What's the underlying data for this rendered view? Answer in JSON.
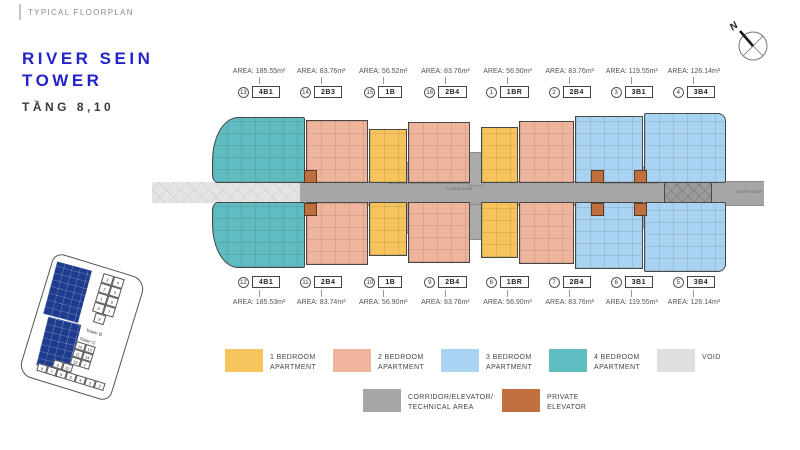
{
  "header": {
    "eyebrow": "TYPICAL FLOORPLAN"
  },
  "title": {
    "line1": "RIVER SEIN",
    "line2": "TOWER",
    "floor": "TẦNG 8,10"
  },
  "compass": {
    "north_label": "N"
  },
  "floorplan": {
    "corridor_label": "CORRIDOR",
    "corridor_label_right": "CORRIDOR",
    "top_row": [
      {
        "num": "13",
        "code": "4B1",
        "area": "AREA: 185.55m²",
        "type": "4br"
      },
      {
        "num": "14",
        "code": "2B3",
        "area": "AREA: 83.76m²",
        "type": "2br"
      },
      {
        "num": "15",
        "code": "1B",
        "area": "AREA: 56.52m²",
        "type": "1br"
      },
      {
        "num": "16",
        "code": "2B4",
        "area": "AREA: 83.76m²",
        "type": "2br"
      },
      {
        "num": "1",
        "code": "1BR",
        "area": "AREA: 56.90m²",
        "type": "1br"
      },
      {
        "num": "2",
        "code": "2B4",
        "area": "AREA: 83.76m²",
        "type": "2br"
      },
      {
        "num": "3",
        "code": "3B1",
        "area": "AREA: 119.55m²",
        "type": "3br"
      },
      {
        "num": "4",
        "code": "3B4",
        "area": "AREA: 126.14m²",
        "type": "3br"
      }
    ],
    "bottom_row": [
      {
        "num": "12",
        "code": "4B1",
        "area": "AREA: 185.53m²",
        "type": "4br"
      },
      {
        "num": "11",
        "code": "2B4",
        "area": "AREA: 83.74m²",
        "type": "2br"
      },
      {
        "num": "10",
        "code": "1B",
        "area": "AREA: 56.90m²",
        "type": "1br"
      },
      {
        "num": "9",
        "code": "2B4",
        "area": "AREA: 83.76m²",
        "type": "2br"
      },
      {
        "num": "8",
        "code": "1BR",
        "area": "AREA: 56.90m²",
        "type": "1br"
      },
      {
        "num": "7",
        "code": "2B4",
        "area": "AREA: 83.76m²",
        "type": "2br"
      },
      {
        "num": "6",
        "code": "3B1",
        "area": "AREA: 119.55m²",
        "type": "3br"
      },
      {
        "num": "5",
        "code": "3B4",
        "area": "AREA: 126.14m²",
        "type": "3br"
      }
    ]
  },
  "legend": {
    "row1": [
      {
        "label": "1 BEDROOM\nAPARTMENT",
        "color_key": "1br"
      },
      {
        "label": "2 BEDROOM\nAPARTMENT",
        "color_key": "2br"
      },
      {
        "label": "3 BEDROOM\nAPARTMENT",
        "color_key": "3br"
      },
      {
        "label": "4 BEDROOM\nAPARTMENT",
        "color_key": "4br"
      },
      {
        "label": "VOID",
        "color_key": "void"
      }
    ],
    "row2": [
      {
        "label": "CORRIDOR/ELEVATOR/\nTECHNICAL AREA",
        "color_key": "corridor"
      },
      {
        "label": "PRIVATE\nELEVATOR",
        "color_key": "private_elevator"
      }
    ]
  },
  "keyplan": {
    "tower_a": {
      "label": "Tower A"
    },
    "tower_b": {
      "label": "Tower B",
      "rows": [
        [
          "3",
          "4"
        ],
        [
          "2",
          "5"
        ],
        [
          "1",
          "6"
        ],
        [
          "9",
          "7"
        ],
        [
          "8"
        ]
      ]
    },
    "tower_c": {
      "label": "Tower C",
      "rows": [
        [
          "12",
          "13"
        ],
        [
          "11",
          "14"
        ],
        [
          "15",
          "1"
        ],
        [
          "9",
          "10"
        ],
        [
          "8",
          "7",
          "6",
          "5",
          "4",
          "3",
          "2"
        ]
      ]
    }
  },
  "colors": {
    "1br": "#F6C35D",
    "2br": "#EFB59C",
    "3br": "#A9D3F2",
    "4br": "#5FBDC2",
    "void": "#DFDFDF",
    "corridor": "#A6A6A6",
    "private_elevator": "#C0703F",
    "accent_blue": "#2323CA",
    "keyplan_navy": "#1E3C8E"
  }
}
